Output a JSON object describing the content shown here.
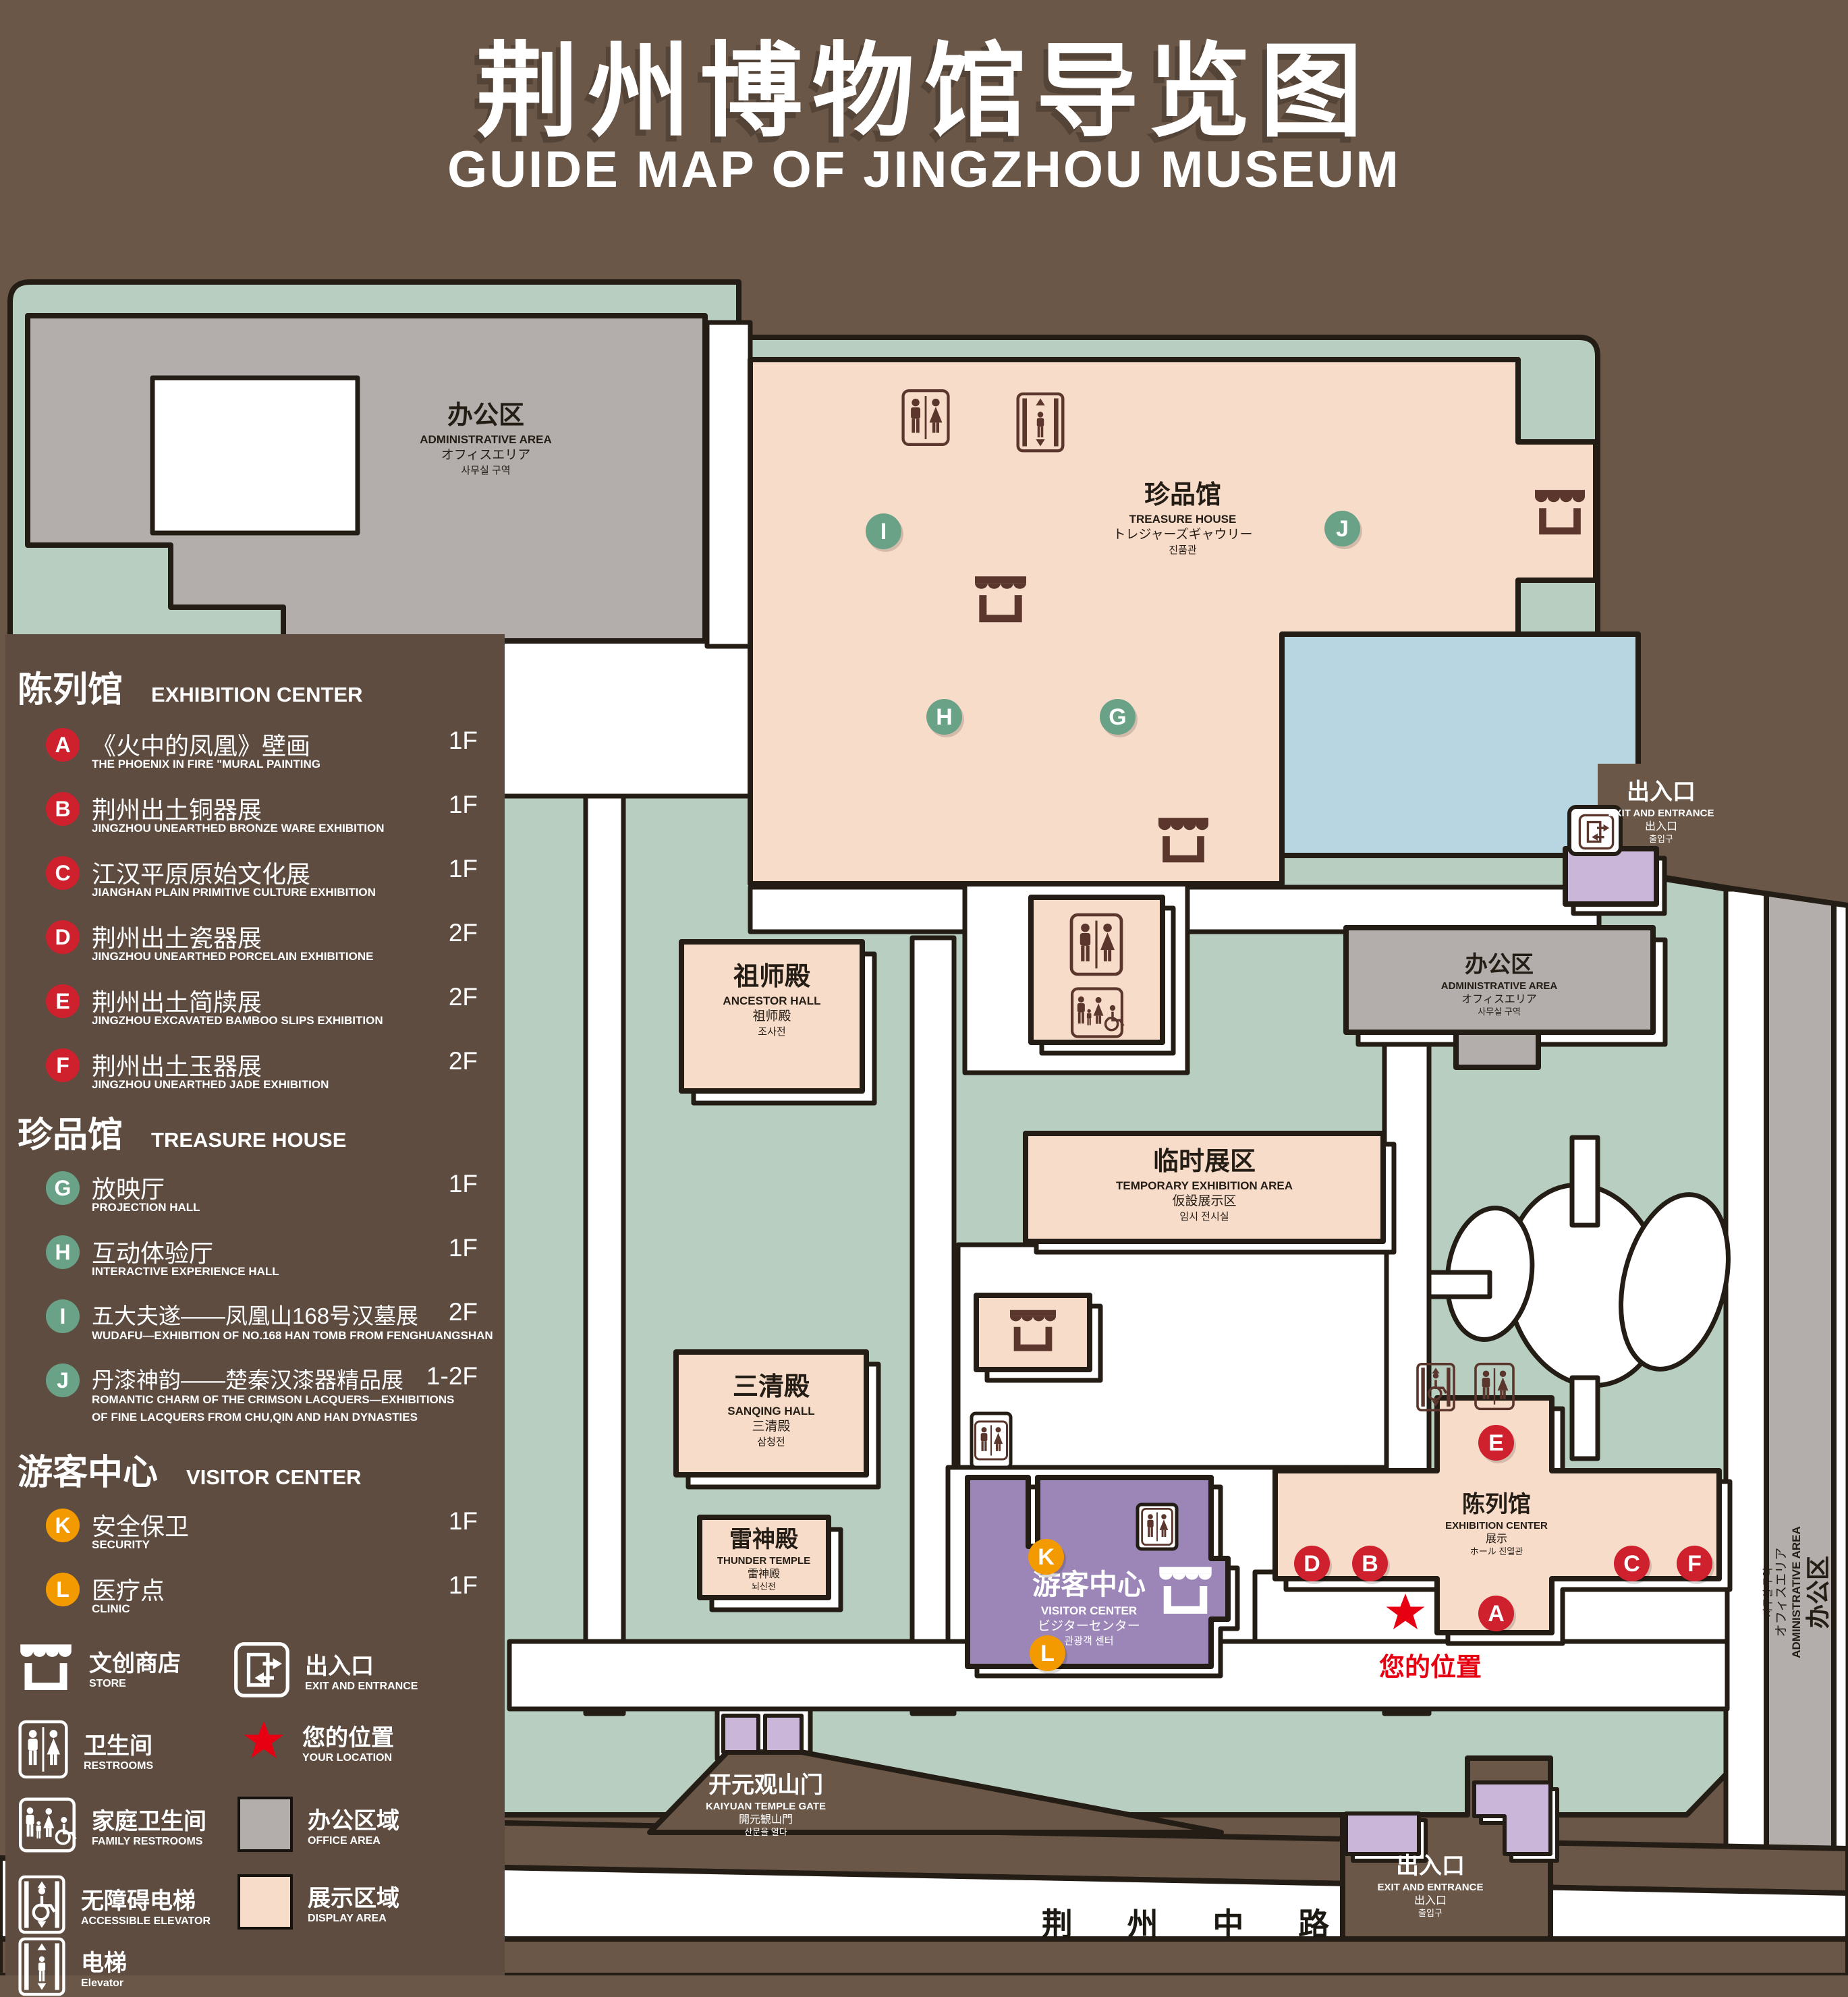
{
  "title": {
    "zh": "荆州博物馆导览图",
    "en": "GUIDE MAP OF JINGZHOU MUSEUM"
  },
  "legend": {
    "sections": [
      {
        "zh": "陈列馆",
        "en": "EXHIBITION CENTER",
        "items": [
          {
            "id": "A",
            "zh": "《火中的凤凰》壁画",
            "en": "THE PHOENIX IN FIRE \"MURAL PAINTING",
            "floor": "1F"
          },
          {
            "id": "B",
            "zh": "荆州出土铜器展",
            "en": "JINGZHOU UNEARTHED BRONZE WARE EXHIBITION",
            "floor": "1F"
          },
          {
            "id": "C",
            "zh": "江汉平原原始文化展",
            "en": "JIANGHAN PLAIN PRIMITIVE CULTURE EXHIBITION",
            "floor": "1F"
          },
          {
            "id": "D",
            "zh": "荆州出土瓷器展",
            "en": "JINGZHOU UNEARTHED PORCELAIN EXHIBITIONE",
            "floor": "2F"
          },
          {
            "id": "E",
            "zh": "荆州出土简牍展",
            "en": "JINGZHOU EXCAVATED BAMBOO SLIPS EXHIBITION",
            "floor": "2F"
          },
          {
            "id": "F",
            "zh": "荆州出土玉器展",
            "en": "JINGZHOU UNEARTHED JADE EXHIBITION",
            "floor": "2F"
          }
        ]
      },
      {
        "zh": "珍品馆",
        "en": "TREASURE HOUSE",
        "items": [
          {
            "id": "G",
            "zh": "放映厅",
            "en": "PROJECTION HALL",
            "floor": "1F"
          },
          {
            "id": "H",
            "zh": "互动体验厅",
            "en": "INTERACTIVE EXPERIENCE HALL",
            "floor": "1F"
          },
          {
            "id": "I",
            "zh": "五大夫遂——凤凰山168号汉墓展",
            "en": "WUDAFU—EXHIBITION OF NO.168 HAN TOMB FROM FENGHUANGSHAN",
            "floor": "2F"
          },
          {
            "id": "J",
            "zh": "丹漆神韵——楚秦汉漆器精品展",
            "en": "ROMANTIC CHARM OF THE CRIMSON LACQUERS—EXHIBITIONS",
            "en2": "OF FINE LACQUERS FROM CHU,QIN AND HAN DYNASTIES",
            "floor": "1-2F"
          }
        ]
      },
      {
        "zh": "游客中心",
        "en": "VISITOR CENTER",
        "items": [
          {
            "id": "K",
            "zh": "安全保卫",
            "en": "SECURITY",
            "floor": "1F"
          },
          {
            "id": "L",
            "zh": "医疗点",
            "en": "CLINIC",
            "floor": "1F"
          }
        ]
      }
    ],
    "symbols": {
      "store": {
        "zh": "文创商店",
        "en": "STORE"
      },
      "restrooms": {
        "zh": "卫生间",
        "en": "RESTROOMS"
      },
      "family": {
        "zh": "家庭卫生间",
        "en": "FAMILY RESTROOMS"
      },
      "accessible": {
        "zh": "无障碍电梯",
        "en": "ACCESSIBLE ELEVATOR"
      },
      "elevator": {
        "zh": "电梯",
        "en": "Elevator"
      },
      "exit": {
        "zh": "出入口",
        "en": "EXIT AND ENTRANCE"
      },
      "location": {
        "zh": "您的位置",
        "en": "YOUR LOCATION"
      },
      "office": {
        "zh": "办公区域",
        "en": "OFFICE AREA"
      },
      "display": {
        "zh": "展示区域",
        "en": "DISPLAY AREA"
      }
    }
  },
  "map": {
    "labels": {
      "admin_nw": {
        "zh": "办公区",
        "en": "ADMINISTRATIVE AREA",
        "ja": "オフィスエリア",
        "ko": "사무실 구역"
      },
      "treasure": {
        "zh": "珍品馆",
        "en": "TREASURE HOUSE",
        "ja": "トレジャーズギャウリー",
        "ko": "진품관"
      },
      "ancestor": {
        "zh": "祖师殿",
        "en": "ANCESTOR HALL",
        "ja": "祖师殿",
        "ko": "조사전"
      },
      "temporary": {
        "zh": "临时展区",
        "en": "TEMPORARY EXHIBITION AREA",
        "ja": "仮設展示区",
        "ko": "임시 전시실"
      },
      "sanqing": {
        "zh": "三清殿",
        "en": "SANQING HALL",
        "ja": "三清殿",
        "ko": "삼청전"
      },
      "admin_right": {
        "zh": "办公区",
        "en": "ADMINISTRATIVE AREA",
        "ja": "オフィスエリア",
        "ko": "사무실 구역"
      },
      "admin_far_right": {
        "zh": "办公区",
        "en": "ADMINISTRATIVE AREA",
        "ja": "オフィスエリア",
        "ko": "사무실 구역"
      },
      "exhibition": {
        "zh": "陈列馆",
        "en": "EXHIBITION CENTER",
        "ja": "展示",
        "ko": "ホール 진열관"
      },
      "thunder": {
        "zh": "雷神殿",
        "en": "THUNDER TEMPLE",
        "ja": "雷神殿",
        "ko": "뇌신전"
      },
      "visitor": {
        "zh": "游客中心",
        "en": "VISITOR CENTER",
        "ja": "ビジターセンター",
        "ko": "관광객 센터"
      },
      "gate": {
        "zh": "开元观山门",
        "en": "KAIYUAN TEMPLE GATE",
        "ja": "開元観山門",
        "ko": "산문을 열다"
      },
      "exit_right": {
        "zh": "出入口",
        "en": "EXIT AND ENTRANCE",
        "ja": "出入口",
        "ko": "출입구"
      },
      "exit_bottom": {
        "zh": "出入口",
        "en": "EXIT AND ENTRANCE",
        "ja": "出入口",
        "ko": "출입구"
      },
      "road": {
        "zh": "荆 州 中 路"
      }
    },
    "markers": [
      {
        "letter": "A"
      },
      {
        "letter": "B"
      },
      {
        "letter": "C"
      },
      {
        "letter": "D"
      },
      {
        "letter": "E"
      },
      {
        "letter": "F"
      },
      {
        "letter": "G"
      },
      {
        "letter": "H"
      },
      {
        "letter": "I"
      },
      {
        "letter": "J"
      },
      {
        "letter": "K"
      },
      {
        "letter": "L"
      }
    ],
    "your_location": {
      "zh": "您的位置"
    }
  },
  "colors": {
    "page_bg": "#6a5748",
    "legend_panel": "#5e4c40",
    "map_green": "#b7cec0",
    "path_white": "#ffffff",
    "display_pink": "#f8dcca",
    "office_gray": "#b3aeab",
    "visitor_purple": "#9c86b8",
    "purple_light": "#c9b6d8",
    "lake_blue": "#b7d6e2",
    "outline": "#241d16",
    "marker_red": "#cf202e",
    "marker_green": "#6aa287",
    "marker_orange": "#f39a00",
    "icon_brown": "#5a362c",
    "location_red": "#e60012"
  }
}
